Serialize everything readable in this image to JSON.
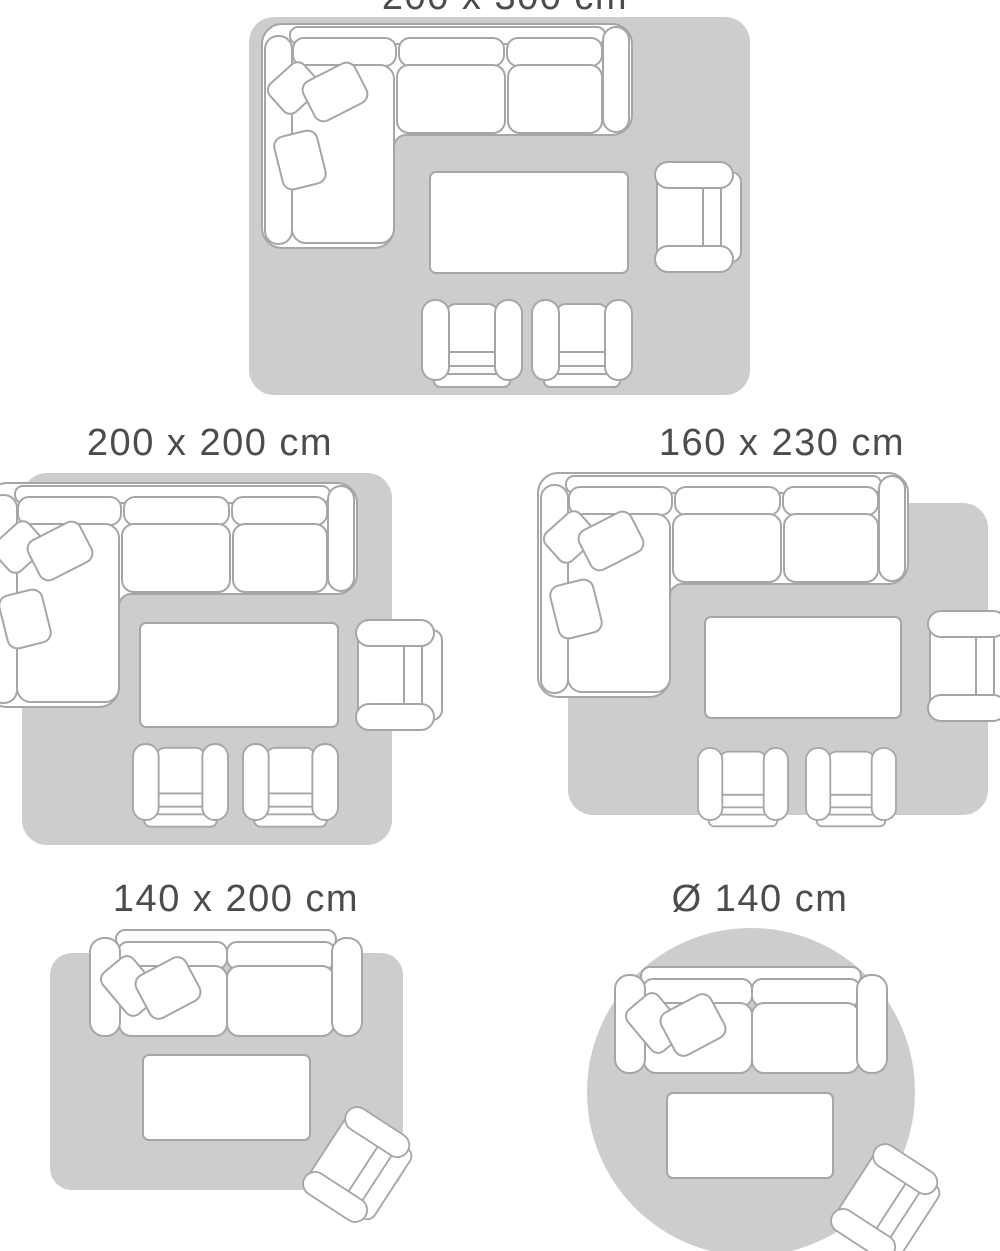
{
  "colors": {
    "background": "#ffffff",
    "rug_fill": "#cdcdcd",
    "furniture_fill": "#ffffff",
    "furniture_outline": "#a6a6a6",
    "label_text": "#4c4c4c"
  },
  "diagrams": [
    {
      "label": "200 x 300 cm",
      "label_note": "partially cut off at top edge of image",
      "rug_shape": "rectangle",
      "furniture": [
        "corner-sofa-with-3-cushions",
        "coffee-table",
        "armchair",
        "club-chair",
        "club-chair"
      ]
    },
    {
      "label": "200 x 200 cm",
      "rug_shape": "rectangle",
      "furniture": [
        "corner-sofa-with-3-cushions",
        "coffee-table",
        "armchair",
        "club-chair",
        "club-chair"
      ]
    },
    {
      "label": "160 x 230 cm",
      "rug_shape": "rectangle",
      "furniture": [
        "corner-sofa-with-3-cushions",
        "coffee-table",
        "armchair",
        "club-chair",
        "club-chair"
      ]
    },
    {
      "label": "140 x 200 cm",
      "rug_shape": "rectangle",
      "furniture": [
        "two-seat-sofa-with-2-cushions",
        "coffee-table",
        "armchair-rotated"
      ]
    },
    {
      "label": "Ø 140 cm",
      "rug_shape": "circle",
      "furniture": [
        "two-seat-sofa-with-2-cushions",
        "coffee-table",
        "armchair-rotated"
      ]
    }
  ]
}
